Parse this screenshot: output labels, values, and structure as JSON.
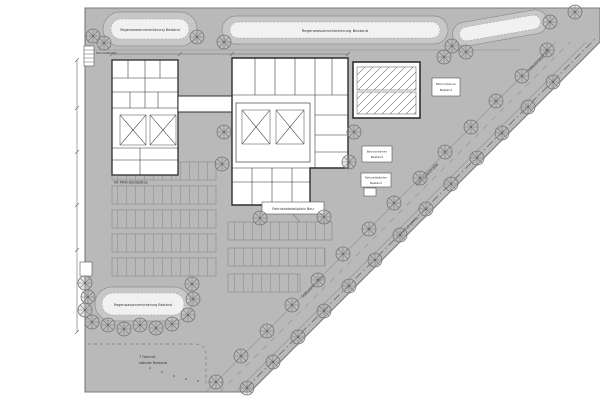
{
  "labels": {
    "basin_top_left": "Regenwasserversickerung Bestand",
    "basin_top_center": "Regenwasserversickerung Bestand",
    "basin_bottom_left": "Regenwasserversickerung Bestand",
    "parking_count": "96 PKW-Stellplätze",
    "muellcontainer_line1": "Müllcontainer",
    "muellcontainer_line2": "Bestand",
    "baucontainer_line1": "Baucontainer",
    "baucontainer_line2": "Bestand",
    "fahrradstaender_line1": "Fahrradständer",
    "fahrradstaender_line2": "Bestand",
    "bike_stands_line1": "7 Fahrrad-",
    "bike_stands_line2": "ständer Bestand",
    "central_sign": "Fahrradabstellplatz Neu",
    "left_small": "Fahrradständer",
    "street_name": "Industriestraße",
    "boundary": "Grundstücksgrenze"
  },
  "colors": {
    "site": "#b9b9b9",
    "ring": "#c7c7c7",
    "inner": "#f1f1f1",
    "bld": "#ffffff",
    "ink": "#2e2e2e",
    "line": "#8a8a8a",
    "tree": "#787878",
    "dim": "#666666"
  }
}
